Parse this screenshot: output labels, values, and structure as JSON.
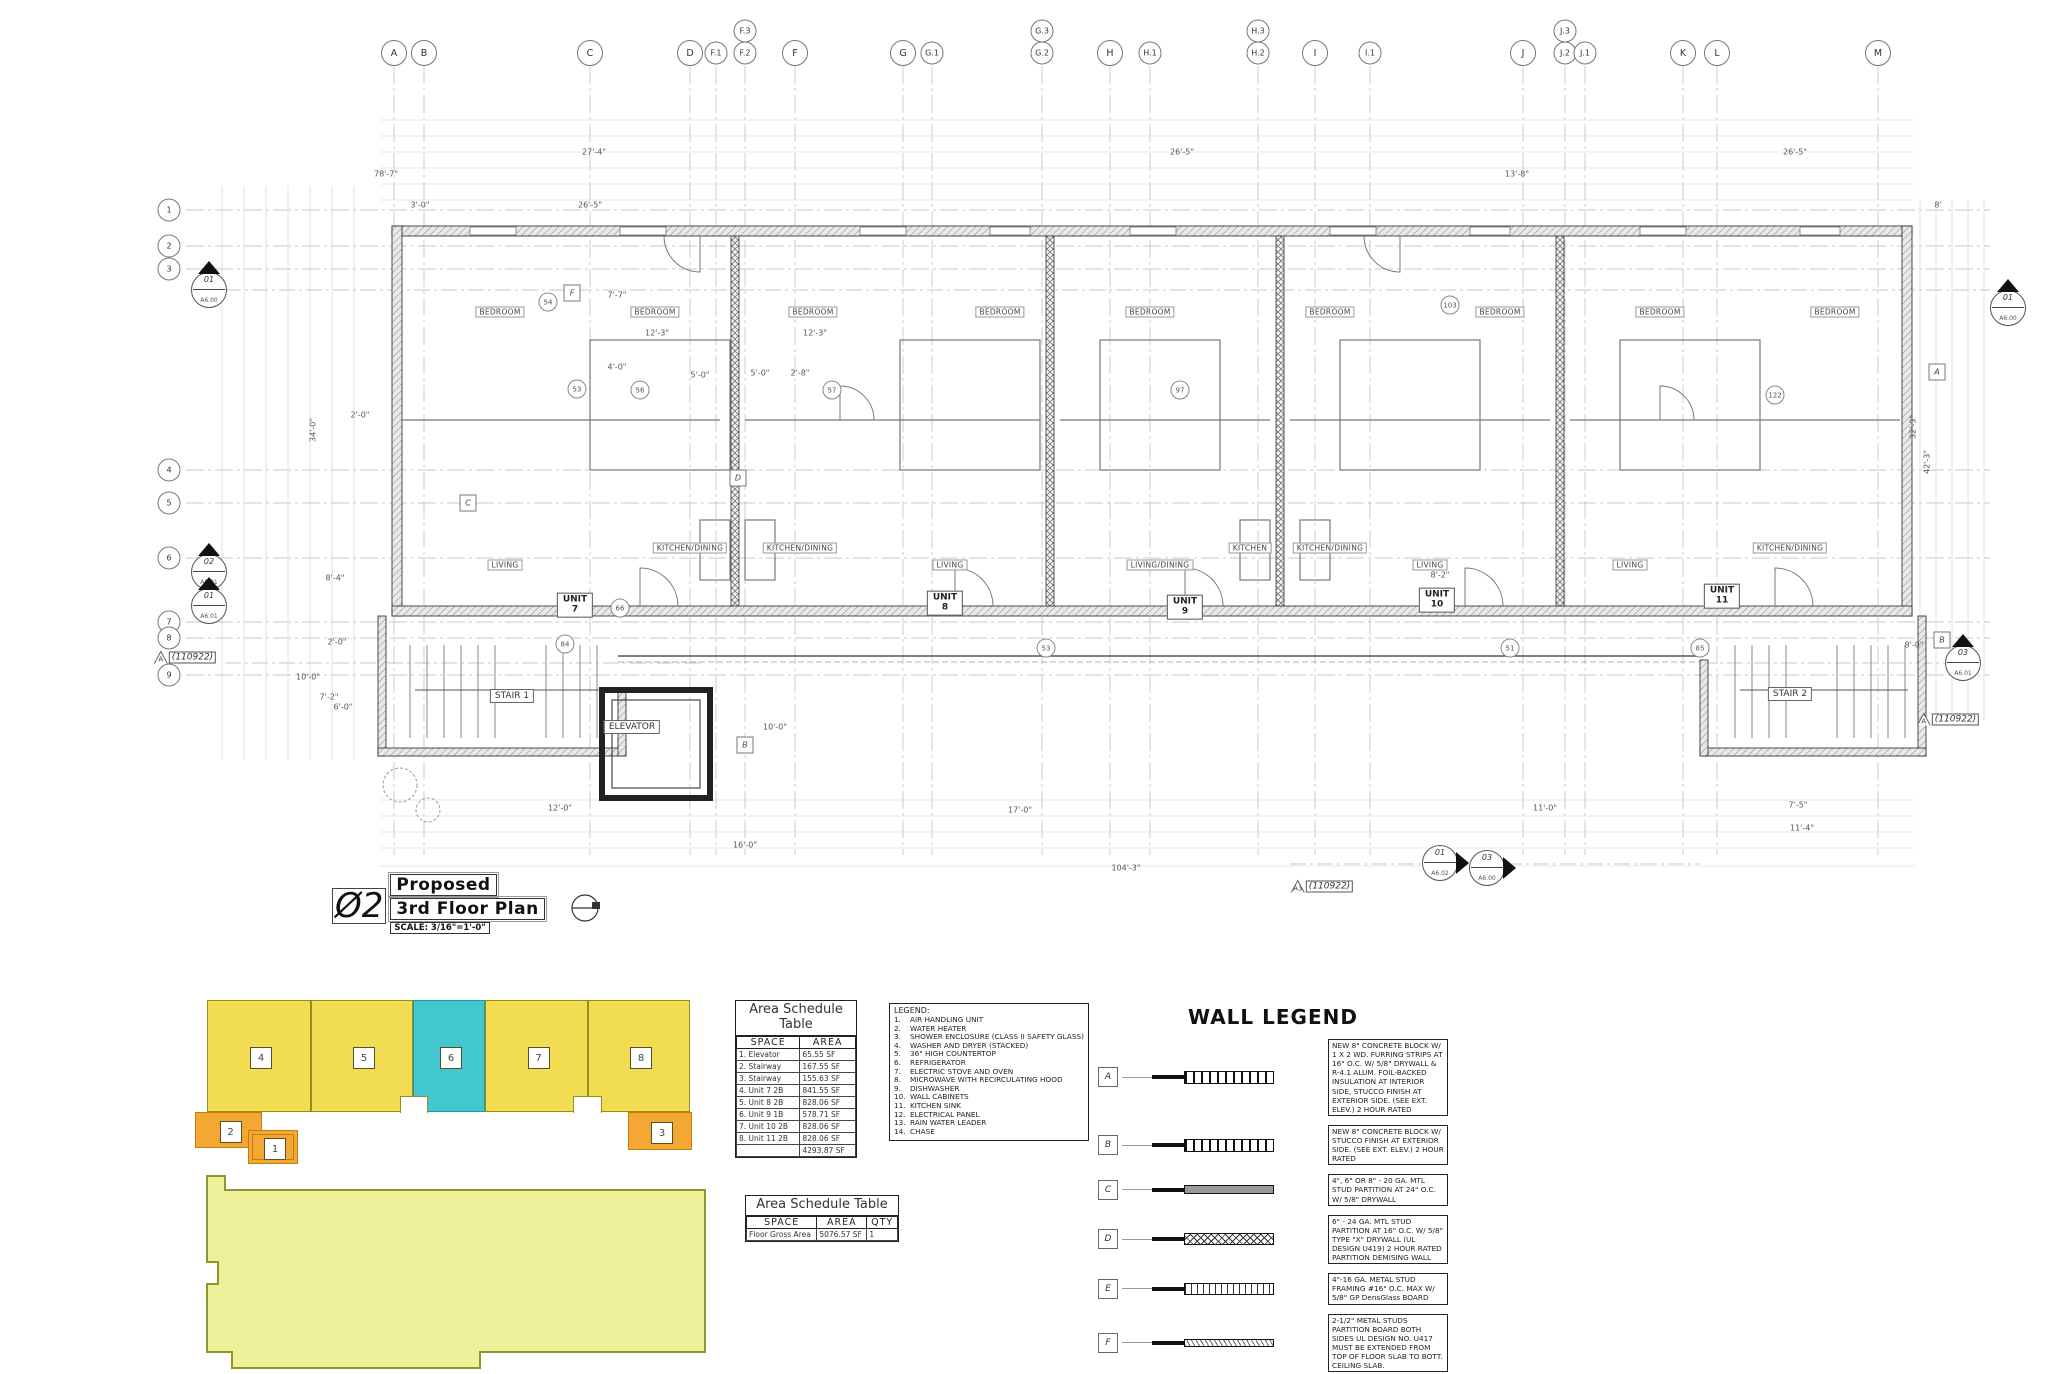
{
  "title_block": {
    "number": "Ø2",
    "line1": "Proposed",
    "line2": "3rd Floor Plan",
    "scale": "SCALE: 3/16\"=1'-0\""
  },
  "grid": {
    "top": [
      {
        "label": "A",
        "x": 394
      },
      {
        "label": "B",
        "x": 424
      },
      {
        "label": "C",
        "x": 590
      },
      {
        "label": "D",
        "x": 690
      },
      {
        "label": "F.1",
        "x": 716
      },
      {
        "label": "F.3",
        "x": 745,
        "stack": true
      },
      {
        "label": "F.2",
        "x": 745
      },
      {
        "label": "F",
        "x": 795
      },
      {
        "label": "G",
        "x": 903
      },
      {
        "label": "G.1",
        "x": 932
      },
      {
        "label": "G.3",
        "x": 1042,
        "stack": true
      },
      {
        "label": "G.2",
        "x": 1042
      },
      {
        "label": "H",
        "x": 1110
      },
      {
        "label": "H.1",
        "x": 1150
      },
      {
        "label": "H.3",
        "x": 1258,
        "stack": true
      },
      {
        "label": "H.2",
        "x": 1258
      },
      {
        "label": "I",
        "x": 1315
      },
      {
        "label": "I.1",
        "x": 1370
      },
      {
        "label": "J",
        "x": 1523
      },
      {
        "label": "J.3",
        "x": 1565,
        "stack": true
      },
      {
        "label": "J.2",
        "x": 1565
      },
      {
        "label": "J.1",
        "x": 1585
      },
      {
        "label": "K",
        "x": 1683
      },
      {
        "label": "L",
        "x": 1717
      },
      {
        "label": "M",
        "x": 1878
      }
    ],
    "left": [
      {
        "label": "1",
        "y": 210
      },
      {
        "label": "2",
        "y": 246
      },
      {
        "label": "3",
        "y": 269
      },
      {
        "label": "4",
        "y": 470
      },
      {
        "label": "5",
        "y": 503
      },
      {
        "label": "6",
        "y": 558
      },
      {
        "label": "7",
        "y": 622
      },
      {
        "label": "8",
        "y": 638
      },
      {
        "label": "9",
        "y": 675
      }
    ]
  },
  "plan": {
    "unit_labels": [
      {
        "label": "UNIT\n7",
        "x": 575,
        "y": 605
      },
      {
        "label": "UNIT\n8",
        "x": 945,
        "y": 603
      },
      {
        "label": "UNIT\n9",
        "x": 1185,
        "y": 607
      },
      {
        "label": "UNIT\n10",
        "x": 1437,
        "y": 600
      },
      {
        "label": "UNIT\n11",
        "x": 1722,
        "y": 596
      }
    ],
    "core_labels": [
      {
        "label": "STAIR 1",
        "x": 512,
        "y": 696
      },
      {
        "label": "ELEVATOR",
        "x": 632,
        "y": 727
      },
      {
        "label": "STAIR 2",
        "x": 1790,
        "y": 694
      }
    ],
    "room_labels": [
      {
        "label": "BEDROOM",
        "x": 500,
        "y": 312
      },
      {
        "label": "BEDROOM",
        "x": 655,
        "y": 312
      },
      {
        "label": "BEDROOM",
        "x": 813,
        "y": 312
      },
      {
        "label": "BEDROOM",
        "x": 1000,
        "y": 312
      },
      {
        "label": "BEDROOM",
        "x": 1150,
        "y": 312
      },
      {
        "label": "BEDROOM",
        "x": 1330,
        "y": 312
      },
      {
        "label": "BEDROOM",
        "x": 1500,
        "y": 312
      },
      {
        "label": "BEDROOM",
        "x": 1660,
        "y": 312
      },
      {
        "label": "BEDROOM",
        "x": 1835,
        "y": 312
      },
      {
        "label": "LIVING",
        "x": 505,
        "y": 565
      },
      {
        "label": "LIVING",
        "x": 950,
        "y": 565
      },
      {
        "label": "LIVING/DINING",
        "x": 1160,
        "y": 565
      },
      {
        "label": "LIVING",
        "x": 1430,
        "y": 565
      },
      {
        "label": "LIVING",
        "x": 1630,
        "y": 565
      },
      {
        "label": "KITCHEN/DINING",
        "x": 690,
        "y": 548
      },
      {
        "label": "KITCHEN/DINING",
        "x": 800,
        "y": 548
      },
      {
        "label": "KITCHEN",
        "x": 1250,
        "y": 548
      },
      {
        "label": "KITCHEN/DINING",
        "x": 1330,
        "y": 548
      },
      {
        "label": "KITCHEN/DINING",
        "x": 1790,
        "y": 548
      }
    ],
    "wall_tags": [
      {
        "t": "F",
        "x": 572,
        "y": 293
      },
      {
        "t": "C",
        "x": 468,
        "y": 503
      },
      {
        "t": "D",
        "x": 738,
        "y": 478
      },
      {
        "t": "A",
        "x": 1937,
        "y": 372
      },
      {
        "t": "B",
        "x": 1942,
        "y": 640
      },
      {
        "t": "B",
        "x": 745,
        "y": 745
      }
    ],
    "circle_tags": [
      {
        "t": "54",
        "x": 548,
        "y": 302
      },
      {
        "t": "53",
        "x": 577,
        "y": 389
      },
      {
        "t": "56",
        "x": 640,
        "y": 390
      },
      {
        "t": "57",
        "x": 832,
        "y": 390
      },
      {
        "t": "66",
        "x": 620,
        "y": 608
      },
      {
        "t": "84",
        "x": 565,
        "y": 644
      },
      {
        "t": "97",
        "x": 1180,
        "y": 390
      },
      {
        "t": "103",
        "x": 1450,
        "y": 305
      },
      {
        "t": "122",
        "x": 1775,
        "y": 395
      },
      {
        "t": "85",
        "x": 1700,
        "y": 648
      },
      {
        "t": "53",
        "x": 1046,
        "y": 648
      },
      {
        "t": "51",
        "x": 1510,
        "y": 648
      }
    ],
    "dim_labels": [
      {
        "t": "27'-4\"",
        "x": 594,
        "y": 152
      },
      {
        "t": "26'-5\"",
        "x": 1182,
        "y": 152
      },
      {
        "t": "26'-5\"",
        "x": 1795,
        "y": 152
      },
      {
        "t": "78'-7\"",
        "x": 386,
        "y": 174
      },
      {
        "t": "13'-8\"",
        "x": 1517,
        "y": 174
      },
      {
        "t": "3'-0\"",
        "x": 420,
        "y": 205
      },
      {
        "t": "26'-5\"",
        "x": 590,
        "y": 205
      },
      {
        "t": "8'",
        "x": 1938,
        "y": 205
      },
      {
        "t": "34'-0\"",
        "x": 313,
        "y": 430,
        "r": -90
      },
      {
        "t": "8'-4\"",
        "x": 335,
        "y": 578
      },
      {
        "t": "2'-0\"",
        "x": 337,
        "y": 642
      },
      {
        "t": "10'-0\"",
        "x": 308,
        "y": 677
      },
      {
        "t": "7'-2\"",
        "x": 329,
        "y": 697
      },
      {
        "t": "6'-0\"",
        "x": 343,
        "y": 707
      },
      {
        "t": "32'-3\"",
        "x": 1913,
        "y": 427,
        "r": -90
      },
      {
        "t": "42'-3\"",
        "x": 1927,
        "y": 462,
        "r": -90
      },
      {
        "t": "8'-0\"",
        "x": 1914,
        "y": 645
      },
      {
        "t": "7'-7\"",
        "x": 617,
        "y": 295
      },
      {
        "t": "12'-3\"",
        "x": 657,
        "y": 333
      },
      {
        "t": "12'-3\"",
        "x": 815,
        "y": 333
      },
      {
        "t": "5'-0\"",
        "x": 700,
        "y": 375
      },
      {
        "t": "5'-0\"",
        "x": 760,
        "y": 373
      },
      {
        "t": "2'-8\"",
        "x": 800,
        "y": 373
      },
      {
        "t": "4'-0\"",
        "x": 617,
        "y": 367
      },
      {
        "t": "8'-2\"",
        "x": 1440,
        "y": 575
      },
      {
        "t": "2'-0\"",
        "x": 360,
        "y": 415
      },
      {
        "t": "10'-0\"",
        "x": 775,
        "y": 727
      },
      {
        "t": "12'-0\"",
        "x": 560,
        "y": 808
      },
      {
        "t": "17'-0\"",
        "x": 1020,
        "y": 810
      },
      {
        "t": "11'-0\"",
        "x": 1545,
        "y": 808
      },
      {
        "t": "7'-5\"",
        "x": 1798,
        "y": 805
      },
      {
        "t": "11'-4\"",
        "x": 1802,
        "y": 828
      },
      {
        "t": "16'-0\"",
        "x": 745,
        "y": 845
      },
      {
        "t": "104'-3\"",
        "x": 1126,
        "y": 868
      }
    ],
    "section_markers": [
      {
        "num": "01",
        "sheet": "A6.00",
        "x": 209,
        "y": 290
      },
      {
        "num": "02",
        "sheet": "A6.01",
        "x": 209,
        "y": 572
      },
      {
        "num": "01",
        "sheet": "A6.01",
        "x": 209,
        "y": 606
      },
      {
        "num": "01",
        "sheet": "A6.00",
        "x": 2008,
        "y": 308
      },
      {
        "num": "03",
        "sheet": "A6.01",
        "x": 1963,
        "y": 663
      },
      {
        "num": "01",
        "sheet": "A6.02",
        "x": 1440,
        "y": 863,
        "dir": "right"
      },
      {
        "num": "03",
        "sheet": "A6.00",
        "x": 1487,
        "y": 868,
        "dir": "right"
      }
    ],
    "revision_tags": [
      {
        "prefix": "A",
        "text": "(110922)",
        "x": 185,
        "y": 657
      },
      {
        "prefix": "A",
        "text": "(110922)",
        "x": 1948,
        "y": 719
      },
      {
        "prefix": "A3",
        "text": "(110922)",
        "x": 1322,
        "y": 886
      }
    ]
  },
  "area_table_1": {
    "title": "Area Schedule Table",
    "headers": [
      "SPACE",
      "AREA"
    ],
    "rows": [
      [
        "1. Elevator",
        "65.55 SF"
      ],
      [
        "2. Stairway",
        "167.55 SF"
      ],
      [
        "3. Stairway",
        "155.63 SF"
      ],
      [
        "4. Unit 7 2B",
        "841.55 SF"
      ],
      [
        "5. Unit 8 2B",
        "828.06 SF"
      ],
      [
        "6. Unit 9 1B",
        "578.71 SF"
      ],
      [
        "7. Unit 10 2B",
        "828.06 SF"
      ],
      [
        "8. Unit 11 2B",
        "828.06 SF"
      ],
      [
        "",
        "4293.87 SF"
      ]
    ]
  },
  "area_table_2": {
    "title": "Area Schedule Table",
    "headers": [
      "SPACE",
      "AREA",
      "QTY"
    ],
    "rows": [
      [
        "Floor Gross Area",
        "5076.57 SF",
        "1"
      ]
    ]
  },
  "legend": {
    "title": "LEGEND:",
    "items": [
      "AIR HANDLING UNIT",
      "WATER HEATER",
      "SHOWER ENCLOSURE (CLASS II SAFETY GLASS)",
      "WASHER AND DRYER (STACKED)",
      "36\" HIGH COUNTERTOP",
      "REFRIGERATOR",
      "ELECTRIC STOVE AND OVEN",
      "MICROWAVE WITH RECIRCULATING HOOD",
      "DISHWASHER",
      "WALL CABINETS",
      "KITCHEN SINK",
      "ELECTRICAL PANEL",
      "RAIN WATER LEADER",
      "CHASE"
    ]
  },
  "wall_legend": {
    "title": "WALL LEGEND",
    "rows": [
      {
        "tag": "A",
        "pattern": "p-block",
        "desc": "NEW 8\" CONCRETE BLOCK W/ 1 X 2 WD. FURRING STRIPS AT 16\" O.C. W/ 5/8\" DRYWALL & R-4.1 ALUM. FOIL-BACKED INSULATION AT INTERIOR SIDE, STUCCO FINISH AT EXTERIOR SIDE. (SEE EXT. ELEV.) 2 HOUR RATED"
      },
      {
        "tag": "B",
        "pattern": "p-block",
        "desc": "NEW 8\" CONCRETE BLOCK W/ STUCCO FINISH AT EXTERIOR SIDE. (SEE EXT. ELEV.) 2 HOUR RATED"
      },
      {
        "tag": "C",
        "pattern": "p-solid",
        "desc": "4\", 6\" OR 8\" - 20 GA. MTL STUD PARTITION AT 24\" O.C. W/ 5/8\" DRYWALL"
      },
      {
        "tag": "D",
        "pattern": "p-cross",
        "desc": "6\" - 24 GA. MTL STUD PARTITION AT 16\" O.C. W/ 5/8\" TYPE \"X\" DRYWALL (UL DESIGN U419) 2 HOUR RATED PARTITION DEMISING WALL"
      },
      {
        "tag": "E",
        "pattern": "p-vlines",
        "desc": "4\"-16 GA. METAL STUD FRAMING #16\" O.C. MAX W/ 5/8\" GP DensGlass BOARD"
      },
      {
        "tag": "F",
        "pattern": "p-diag",
        "desc": "2-1/2\" METAL STUDS PARTITION BOARD BOTH SIDES UL DESIGN NO. U417 MUST BE EXTENDED FROM TOP OF FLOOR SLAB TO BOTT. CEILING SLAB."
      }
    ]
  },
  "key_plan": {
    "colors": {
      "yellow": "#f1dc52",
      "teal": "#41c7cd",
      "orange": "#f5a733",
      "pale": "#eef09a",
      "outline": "#9b8a1d",
      "pale_outline": "#8f962e"
    },
    "blocks": [
      {
        "num": "4",
        "x": 207,
        "y": 1000,
        "w": 104,
        "h": 112,
        "color": "yellow"
      },
      {
        "num": "5",
        "x": 311,
        "y": 1000,
        "w": 102,
        "h": 112,
        "color": "yellow"
      },
      {
        "num": "6",
        "x": 413,
        "y": 1000,
        "w": 72,
        "h": 112,
        "color": "teal"
      },
      {
        "num": "7",
        "x": 485,
        "y": 1000,
        "w": 103,
        "h": 112,
        "color": "yellow"
      },
      {
        "num": "8",
        "x": 588,
        "y": 1000,
        "w": 102,
        "h": 112,
        "color": "yellow"
      },
      {
        "num": "2",
        "x": 195,
        "y": 1112,
        "w": 67,
        "h": 36,
        "color": "orange"
      },
      {
        "num": "1",
        "x": 248,
        "y": 1130,
        "w": 50,
        "h": 34,
        "color": "orange",
        "double": true
      },
      {
        "num": "3",
        "x": 628,
        "y": 1112,
        "w": 64,
        "h": 38,
        "color": "orange"
      }
    ],
    "notches": [
      {
        "x": 400,
        "y": 1096,
        "w": 26,
        "h": 16
      },
      {
        "x": 573,
        "y": 1096,
        "w": 27,
        "h": 16
      }
    ]
  }
}
